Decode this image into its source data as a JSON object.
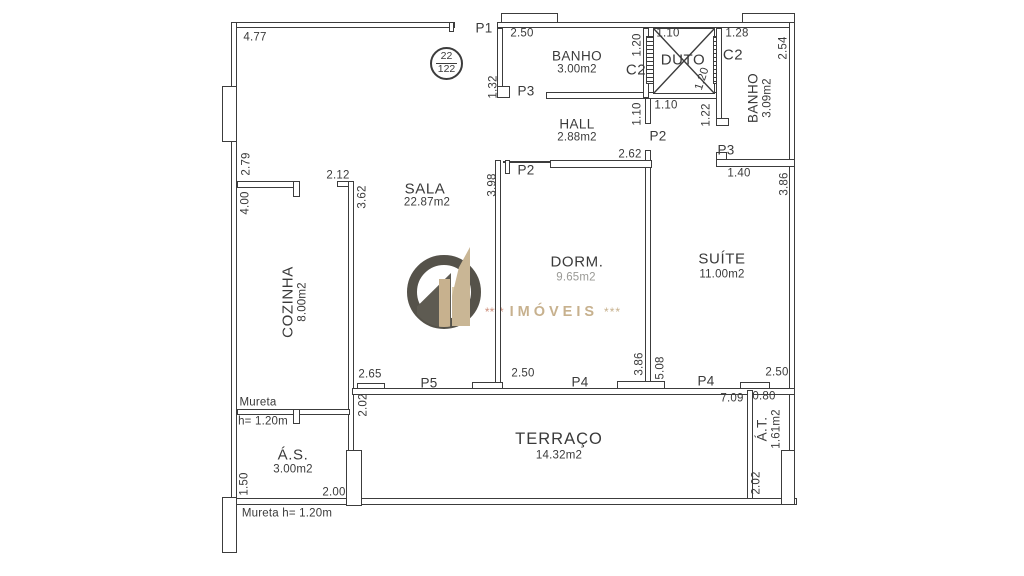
{
  "colors": {
    "line": "#3c3c3c",
    "text": "#3a3a3a",
    "area_muted": "#9a9a96",
    "logo_ring": "#55524a",
    "logo_tan": "#c7b18e",
    "logo_tan_light": "#dccdab",
    "logo_dark": "#5e5b52",
    "logo_stars_left": "#cc8f7c"
  },
  "badge": {
    "top": "22",
    "bottom": "122"
  },
  "logo": {
    "stars_left": "****",
    "brand": "IMÓVEIS",
    "stars_right": "***"
  },
  "rooms": {
    "banho1": {
      "name": "BANHO",
      "area": "3.00m2"
    },
    "c2_left": {
      "name": "C2"
    },
    "duto": {
      "name": "DUTO"
    },
    "c2_right": {
      "name": "C2"
    },
    "banho2": {
      "name": "BANHO",
      "area": "3.09m2"
    },
    "hall": {
      "name": "HALL",
      "area": "2.88m2"
    },
    "sala": {
      "name": "SALA",
      "area": "22.87m2"
    },
    "cozinha": {
      "name": "COZINHA",
      "area": "8.00m2"
    },
    "dorm": {
      "name": "DORM.",
      "area": "9.65m2"
    },
    "suite": {
      "name": "SUÍTE",
      "area": "11.00m2"
    },
    "terraco": {
      "name": "TERRAÇO",
      "area": "14.32m2"
    },
    "as": {
      "name": "Á.S.",
      "area": "3.00m2"
    },
    "at": {
      "name": "Á.T.",
      "area": "1.61m2"
    }
  },
  "doors": {
    "p1": "P1",
    "p3_banho1": "P3",
    "p2_dorm": "P2",
    "p2_hall": "P2",
    "p3_banho2": "P3",
    "p5_sala": "P5",
    "p4_dorm": "P4",
    "p4_suite": "P4"
  },
  "dims": {
    "top_wall": "4.77",
    "banho1_w": "2.50",
    "duto_w": "1.10",
    "banho2_w": "1.28",
    "banho2_h": "2.54",
    "c2l_h": "1.20",
    "duto_d": "1.20",
    "banho1_h": "1.32",
    "left_upper": "2.79",
    "cozinha_h": "4.00",
    "cozinha_top": "2.12",
    "sala_left": "3.62",
    "dorm_h": "3.98",
    "dorm_w": "2.62",
    "corridor_w": "1.10",
    "hall_right": "1.10",
    "banho2_left": "1.22",
    "banho2_bottom": "1.40",
    "suite_right": "3.86",
    "sala_bottom": "2.65",
    "dorm_bottom": "2.50",
    "dorm_right": "3.86",
    "suite_left": "5.08",
    "suite_bottom": "2.50",
    "terraco_w": "7.09",
    "at_w": "0.80",
    "terraco_left": "2.02",
    "at_h": "2.02",
    "as_h": "1.50",
    "as_w": "2.00"
  },
  "notes": {
    "mureta": "Mureta",
    "mureta_height": "h= 1.20m",
    "mureta_bottom": "Mureta h= 1.20m"
  }
}
